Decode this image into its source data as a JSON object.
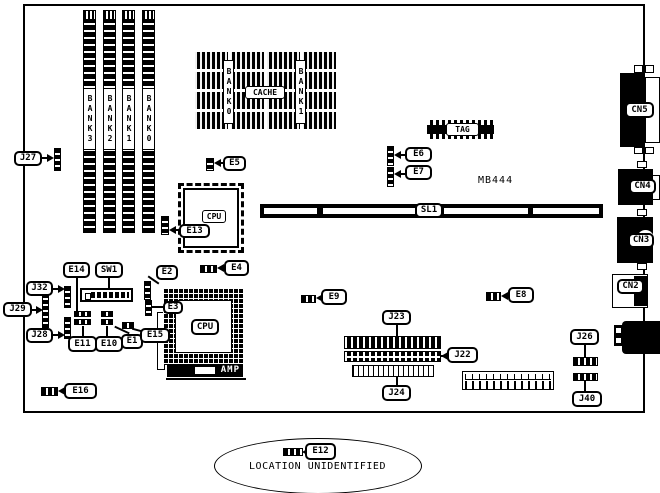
{
  "figure": {
    "note": "MB444",
    "memory_banks": [
      "BANK3",
      "BANK2",
      "BANK1",
      "BANK0"
    ],
    "cache": {
      "bank0": "BANK0",
      "bank1": "BANK1",
      "label": "CACHE",
      "tag": "TAG"
    },
    "slot": {
      "sl1": "SL1"
    },
    "cpu": {
      "qfp": "CPU",
      "socket": "CPU",
      "amp": "AMP"
    },
    "switches": {
      "sw1": "SW1"
    },
    "rear_connectors": {
      "cn5": "CN5",
      "cn4": "CN4",
      "cn3": "CN3",
      "cn2": "CN2"
    },
    "jumpers": {
      "j27": "J27",
      "j32": "J32",
      "j29": "J29",
      "j28": "J28",
      "j26": "J26",
      "j40": "J40",
      "j23": "J23",
      "j22": "J22",
      "j24": "J24",
      "e1": "E1",
      "e2": "E2",
      "e3": "E3",
      "e4": "E4",
      "e5": "E5",
      "e6": "E6",
      "e7": "E7",
      "e8": "E8",
      "e9": "E9",
      "e10": "E10",
      "e11": "E11",
      "e13": "E13",
      "e14": "E14",
      "e15": "E15",
      "e16": "E16"
    },
    "unidentified": {
      "jumper": "E12",
      "note": "LOCATION UNIDENTIFIED"
    }
  }
}
